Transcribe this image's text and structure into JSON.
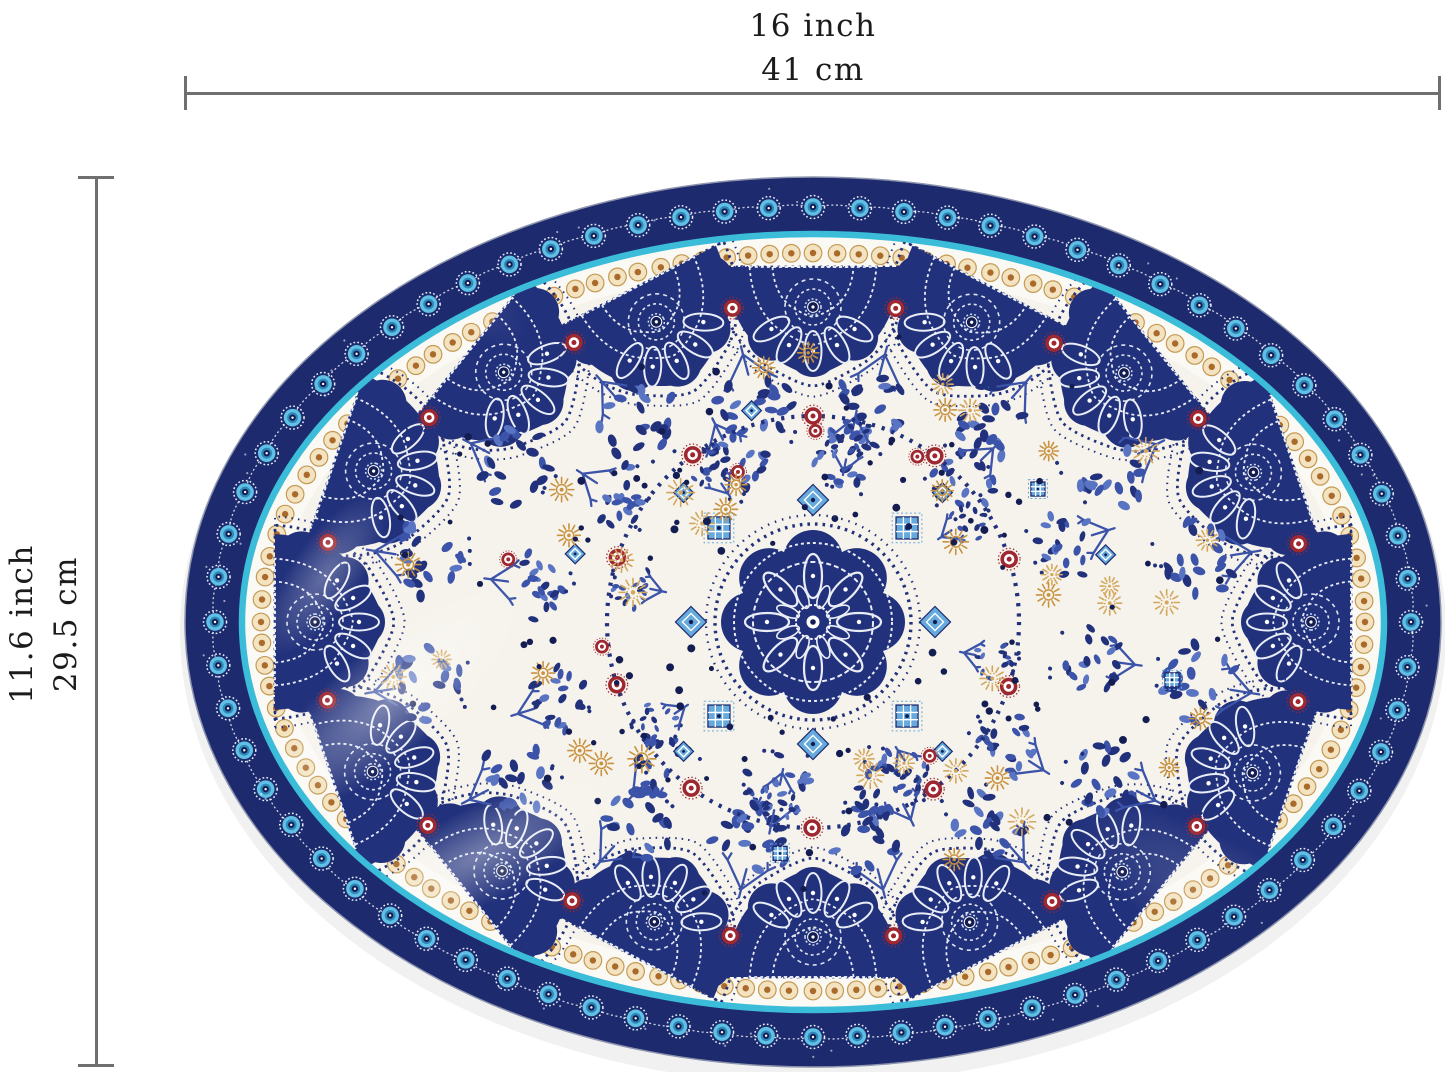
{
  "dimensions": {
    "width": {
      "inch": "16 inch",
      "cm": "41 cm"
    },
    "height": {
      "inch": "11.6 inch",
      "cm": "29.5 cm"
    }
  },
  "measure": {
    "line_color": "#6f6f6f",
    "text_color": "#1b1b1b"
  },
  "plate": {
    "shape": "oval-platter",
    "colors": {
      "band_navy": "#1d2a6e",
      "navy": "#22317c",
      "navy_dark": "#131d52",
      "royal_blue": "#3b53a8",
      "soft_blue": "#5a74c4",
      "eye_blue": "#5fc0e4",
      "eye_teal": "#2f86b8",
      "cyan_ring": "#3bbcd9",
      "white_band": "#fbf9f4",
      "bead_cream": "#f3e3c0",
      "bead_gold": "#c49a55",
      "bead_rust": "#a96a2b",
      "gold": "#c8923f",
      "gold_light": "#d3a75c",
      "red": "#9e2730",
      "ivory": "#f6f3ec",
      "sky_blue": "#66a9dc",
      "white": "#ffffff"
    },
    "pattern": {
      "border_eyes": 72,
      "beads": 132,
      "rim_medallions": 16,
      "rim_rosettes": 16,
      "rim_sprays": 16,
      "mid_sprays": 12,
      "wreath_sprays": 8,
      "ring_rosettes": 10,
      "scatter_rosettes": 6,
      "gold_suns": 40,
      "scatter_dots": 110
    }
  }
}
